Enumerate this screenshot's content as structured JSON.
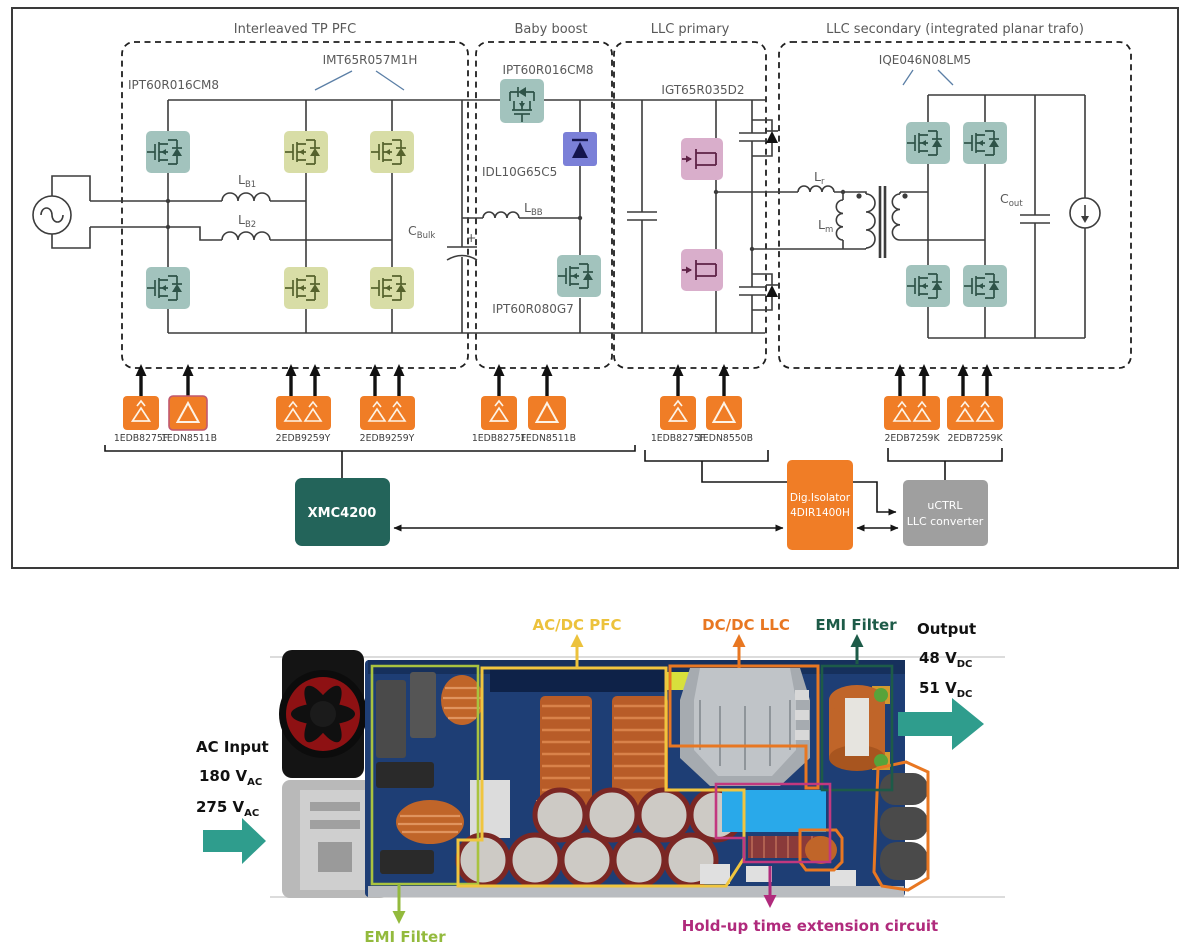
{
  "schematic": {
    "sections": [
      {
        "label": "Interleaved TP PFC"
      },
      {
        "label": "Baby boost"
      },
      {
        "label": "LLC primary"
      },
      {
        "label": "LLC secondary (integrated planar trafo)"
      }
    ],
    "parts": {
      "pfc_first_leg_fet": "IPT60R016CM8",
      "pfc_fast_leg_fet": "IMT65R057M1H",
      "boost_top_fet": "IPT60R016CM8",
      "boost_diode": "IDL10G65C5",
      "boost_bottom_fet": "IPT60R080G7",
      "llc_primary_igbt": "IGT65R035D2",
      "llc_secondary_fet": "IQE046N08LM5"
    },
    "passives": {
      "lb1": {
        "m": "L",
        "s": "B1"
      },
      "lb2": {
        "m": "L",
        "s": "B2"
      },
      "cbulk": {
        "m": "C",
        "s": "Bulk"
      },
      "cbulk_plus": "+",
      "lbb": {
        "m": "L",
        "s": "BB"
      },
      "lr": {
        "m": "L",
        "s": "r"
      },
      "lm": {
        "m": "L",
        "s": "m"
      },
      "cout": {
        "m": "C",
        "s": "out"
      }
    },
    "drivers": [
      {
        "label": "1EDB8275F",
        "type": "single-level-shift"
      },
      {
        "label": "1EDN8511B",
        "type": "single-lowside"
      },
      {
        "label": "2EDB9259Y",
        "type": "dual-isolated"
      },
      {
        "label": "2EDB9259Y",
        "type": "dual-isolated"
      },
      {
        "label": "1EDB8275F",
        "type": "single-level-shift"
      },
      {
        "label": "1EDN8511B",
        "type": "single-lowside"
      },
      {
        "label": "1EDB8275F",
        "type": "single-level-shift"
      },
      {
        "label": "1EDN8550B",
        "type": "single-lowside"
      },
      {
        "label": "2EDB7259K",
        "type": "dual-isolated"
      },
      {
        "label": "2EDB7259K",
        "type": "dual-isolated"
      }
    ],
    "controllers": {
      "xmc": "XMC4200",
      "isolator_line1": "Dig.Isolator",
      "isolator_line2": "4DIR1400H",
      "uctrl_line1": "uCTRL",
      "uctrl_line2": "LLC converter"
    }
  },
  "photo": {
    "labels": {
      "pfc": "AC/DC PFC",
      "llc": "DC/DC LLC",
      "emi_top": "EMI Filter",
      "emi_bottom": "EMI Filter",
      "holdup": "Hold-up time extension circuit"
    },
    "output": {
      "title": "Output",
      "v1": "48 V",
      "v1_sub": "DC",
      "v2": "51 V",
      "v2_sub": "DC"
    },
    "ac_input": {
      "title": "AC Input",
      "v1": "180 V",
      "v1_sub": "AC",
      "v2": "275 V",
      "v2_sub": "AC"
    }
  },
  "colors": {
    "fet_teal": "#a2c3bd",
    "fet_olive": "#d8dda6",
    "igbt_pink": "#d9aecb",
    "diode_blue": "#7b80d8",
    "driver_orange": "#f07d26",
    "mcu_teal": "#23645a",
    "uctrl_gray": "#9f9f9f",
    "ann_yellow": "#ecc23c",
    "ann_orange": "#e87722",
    "ann_dark_green": "#1d5b48",
    "ann_olive": "#93ba3d",
    "ann_magenta": "#b02a7c",
    "flow_teal": "#2f9d8d"
  }
}
